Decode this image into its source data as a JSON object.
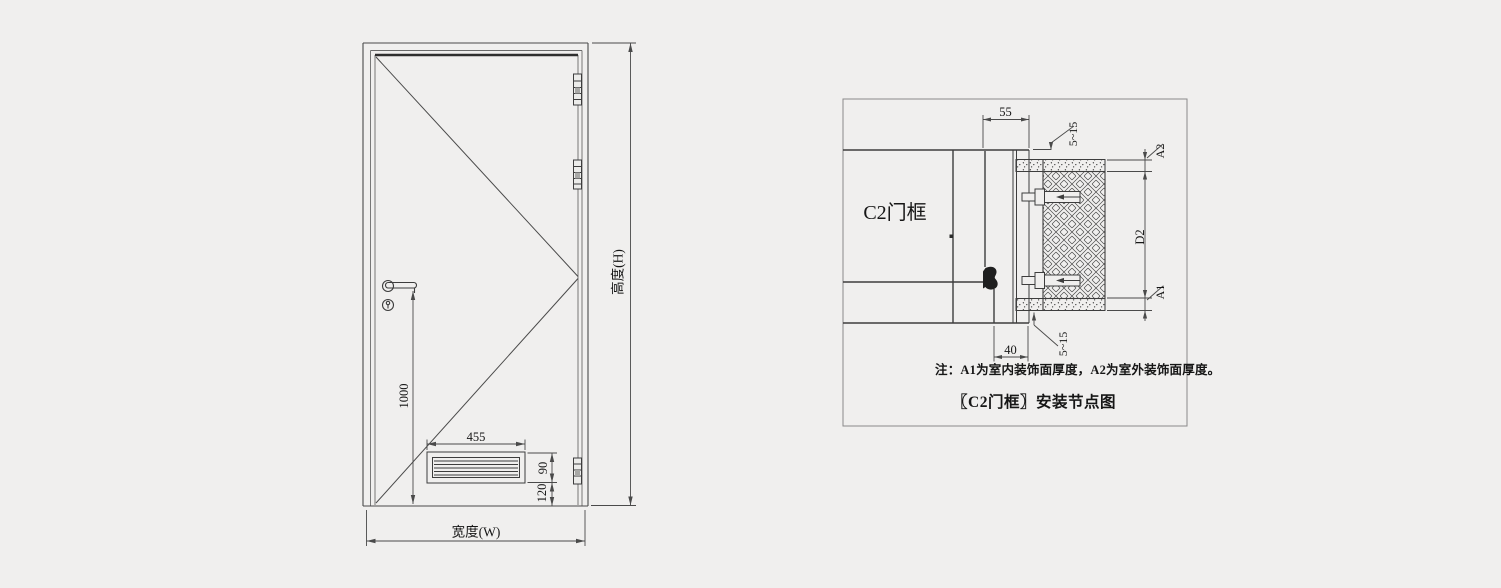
{
  "canvas": {
    "background": "#f0efee",
    "line_color": "#3d3d3d"
  },
  "door_elevation": {
    "dim_height": "高度(H)",
    "dim_width": "宽度(W)",
    "dim_handle_height": "1000",
    "dim_louver_width": "455",
    "dim_louver_height": "90",
    "dim_louver_offset": "120"
  },
  "frame_detail": {
    "frame_label": "C2门框",
    "dim_frame_depth": "55",
    "dim_gap_top": "5~15",
    "dim_gap_bottom": "5~15",
    "dim_face": "40",
    "dim_finish_outer": "A2",
    "dim_wall": "D2",
    "dim_finish_inner": "A1",
    "note": "注：A1为室内装饰面厚度，A2为室外装饰面厚度。",
    "caption": "〖C2门框〗安装节点图"
  }
}
